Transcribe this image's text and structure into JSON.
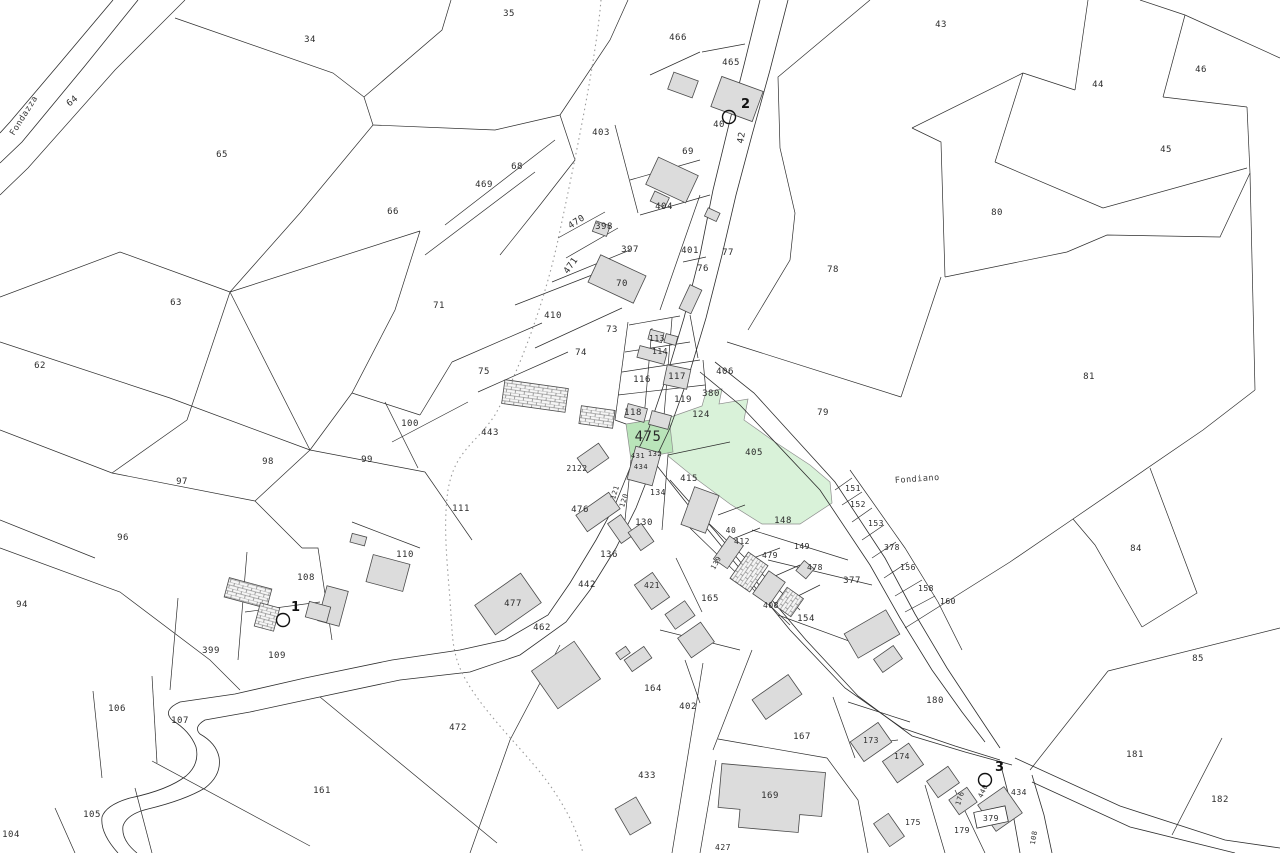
{
  "map": {
    "type": "cadastral-parcel-map",
    "background_color": "#ffffff",
    "line_color": "#2e2e2e",
    "building_fill": "#dcdcdc",
    "highlight_fill": "#d9f2d9",
    "highlight_strong_fill": "#b9e4b9",
    "street_names": [
      {
        "text": "Fondazza",
        "x": 14,
        "y": 136,
        "rotation": -58,
        "size": 8.5,
        "letter_spacing": 3
      },
      {
        "text": "Fondiano",
        "x": 895,
        "y": 483,
        "rotation": -4,
        "size": 8.5,
        "letter_spacing": 2
      }
    ],
    "parcel_labels": [
      {
        "t": "34",
        "x": 310,
        "y": 42
      },
      {
        "t": "35",
        "x": 509,
        "y": 16
      },
      {
        "t": "466",
        "x": 678,
        "y": 40
      },
      {
        "t": "465",
        "x": 731,
        "y": 65
      },
      {
        "t": "40",
        "x": 719,
        "y": 127
      },
      {
        "t": "42",
        "x": 744,
        "y": 138,
        "r": -80
      },
      {
        "t": "403",
        "x": 601,
        "y": 135
      },
      {
        "t": "69",
        "x": 688,
        "y": 154
      },
      {
        "t": "43",
        "x": 941,
        "y": 27
      },
      {
        "t": "46",
        "x": 1201,
        "y": 72
      },
      {
        "t": "44",
        "x": 1098,
        "y": 87
      },
      {
        "t": "45",
        "x": 1166,
        "y": 152
      },
      {
        "t": "64",
        "x": 74,
        "y": 103,
        "r": -40
      },
      {
        "t": "65",
        "x": 222,
        "y": 157
      },
      {
        "t": "68",
        "x": 517,
        "y": 169
      },
      {
        "t": "469",
        "x": 484,
        "y": 187
      },
      {
        "t": "404",
        "x": 664,
        "y": 209
      },
      {
        "t": "66",
        "x": 393,
        "y": 214
      },
      {
        "t": "80",
        "x": 997,
        "y": 215
      },
      {
        "t": "470",
        "x": 578,
        "y": 224,
        "r": -33
      },
      {
        "t": "398",
        "x": 604,
        "y": 229
      },
      {
        "t": "397",
        "x": 630,
        "y": 252
      },
      {
        "t": "471",
        "x": 573,
        "y": 267,
        "r": -55
      },
      {
        "t": "401",
        "x": 690,
        "y": 253
      },
      {
        "t": "77",
        "x": 728,
        "y": 255
      },
      {
        "t": "76",
        "x": 703,
        "y": 271
      },
      {
        "t": "70",
        "x": 622,
        "y": 286
      },
      {
        "t": "78",
        "x": 833,
        "y": 272
      },
      {
        "t": "63",
        "x": 176,
        "y": 305
      },
      {
        "t": "71",
        "x": 439,
        "y": 308
      },
      {
        "t": "410",
        "x": 553,
        "y": 318
      },
      {
        "t": "73",
        "x": 612,
        "y": 332
      },
      {
        "t": "74",
        "x": 581,
        "y": 355
      },
      {
        "t": "113",
        "x": 657,
        "y": 341,
        "s": 8
      },
      {
        "t": "114",
        "x": 660,
        "y": 354,
        "s": 8
      },
      {
        "t": "62",
        "x": 40,
        "y": 368
      },
      {
        "t": "75",
        "x": 484,
        "y": 374
      },
      {
        "t": "116",
        "x": 642,
        "y": 382
      },
      {
        "t": "117",
        "x": 677,
        "y": 379
      },
      {
        "t": "406",
        "x": 725,
        "y": 374
      },
      {
        "t": "380",
        "x": 711,
        "y": 396
      },
      {
        "t": "81",
        "x": 1089,
        "y": 379
      },
      {
        "t": "119",
        "x": 683,
        "y": 402
      },
      {
        "t": "79",
        "x": 823,
        "y": 415
      },
      {
        "t": "124",
        "x": 701,
        "y": 417
      },
      {
        "t": "118",
        "x": 633,
        "y": 415
      },
      {
        "t": "100",
        "x": 410,
        "y": 426
      },
      {
        "t": "443",
        "x": 490,
        "y": 435
      },
      {
        "t": "475",
        "x": 648,
        "y": 441,
        "s": 14
      },
      {
        "t": "98",
        "x": 268,
        "y": 464
      },
      {
        "t": "99",
        "x": 367,
        "y": 462
      },
      {
        "t": "2122",
        "x": 577,
        "y": 471,
        "s": 8
      },
      {
        "t": "431",
        "x": 638,
        "y": 458,
        "s": 7
      },
      {
        "t": "132",
        "x": 655,
        "y": 456,
        "s": 7
      },
      {
        "t": "434",
        "x": 641,
        "y": 469,
        "s": 7
      },
      {
        "t": "405",
        "x": 754,
        "y": 455
      },
      {
        "t": "415",
        "x": 689,
        "y": 481
      },
      {
        "t": "97",
        "x": 182,
        "y": 484
      },
      {
        "t": "151",
        "x": 853,
        "y": 491,
        "s": 8
      },
      {
        "t": "134",
        "x": 658,
        "y": 495,
        "s": 8
      },
      {
        "t": "121",
        "x": 617,
        "y": 493,
        "r": -72,
        "s": 7
      },
      {
        "t": "120",
        "x": 626,
        "y": 501,
        "r": -72,
        "s": 7
      },
      {
        "t": "152",
        "x": 858,
        "y": 507,
        "s": 8
      },
      {
        "t": "476",
        "x": 580,
        "y": 512
      },
      {
        "t": "111",
        "x": 461,
        "y": 511
      },
      {
        "t": "148",
        "x": 783,
        "y": 523
      },
      {
        "t": "130",
        "x": 644,
        "y": 525
      },
      {
        "t": "153",
        "x": 876,
        "y": 526,
        "s": 8
      },
      {
        "t": "40",
        "x": 731,
        "y": 533,
        "s": 8
      },
      {
        "t": "96",
        "x": 123,
        "y": 540
      },
      {
        "t": "412",
        "x": 742,
        "y": 544,
        "s": 8
      },
      {
        "t": "84",
        "x": 1136,
        "y": 551
      },
      {
        "t": "378",
        "x": 892,
        "y": 550,
        "s": 8
      },
      {
        "t": "149",
        "x": 802,
        "y": 549,
        "s": 8
      },
      {
        "t": "110",
        "x": 405,
        "y": 557
      },
      {
        "t": "136",
        "x": 609,
        "y": 557
      },
      {
        "t": "479",
        "x": 770,
        "y": 558,
        "s": 8
      },
      {
        "t": "139",
        "x": 718,
        "y": 564,
        "r": -60,
        "s": 7
      },
      {
        "t": "156",
        "x": 908,
        "y": 570,
        "s": 8
      },
      {
        "t": "478",
        "x": 815,
        "y": 570,
        "s": 8
      },
      {
        "t": "108",
        "x": 306,
        "y": 580
      },
      {
        "t": "377",
        "x": 852,
        "y": 583
      },
      {
        "t": "442",
        "x": 587,
        "y": 587
      },
      {
        "t": "421",
        "x": 652,
        "y": 588,
        "s": 8
      },
      {
        "t": "158",
        "x": 926,
        "y": 591,
        "s": 8
      },
      {
        "t": "165",
        "x": 710,
        "y": 601
      },
      {
        "t": "160",
        "x": 948,
        "y": 604,
        "s": 8
      },
      {
        "t": "94",
        "x": 22,
        "y": 607
      },
      {
        "t": "477",
        "x": 513,
        "y": 606
      },
      {
        "t": "408",
        "x": 771,
        "y": 608,
        "s": 8
      },
      {
        "t": "154",
        "x": 806,
        "y": 621
      },
      {
        "t": "462",
        "x": 542,
        "y": 630
      },
      {
        "t": "399",
        "x": 211,
        "y": 653
      },
      {
        "t": "109",
        "x": 277,
        "y": 658
      },
      {
        "t": "85",
        "x": 1198,
        "y": 661
      },
      {
        "t": "164",
        "x": 653,
        "y": 691
      },
      {
        "t": "180",
        "x": 935,
        "y": 703
      },
      {
        "t": "402",
        "x": 688,
        "y": 709
      },
      {
        "t": "106",
        "x": 117,
        "y": 711
      },
      {
        "t": "107",
        "x": 180,
        "y": 723
      },
      {
        "t": "472",
        "x": 458,
        "y": 730
      },
      {
        "t": "167",
        "x": 802,
        "y": 739
      },
      {
        "t": "173",
        "x": 871,
        "y": 743,
        "s": 8
      },
      {
        "t": "181",
        "x": 1135,
        "y": 757
      },
      {
        "t": "174",
        "x": 902,
        "y": 759,
        "s": 8
      },
      {
        "t": "433",
        "x": 647,
        "y": 778
      },
      {
        "t": "161",
        "x": 322,
        "y": 793
      },
      {
        "t": "176",
        "x": 962,
        "y": 799,
        "r": -72,
        "s": 7
      },
      {
        "t": "440",
        "x": 985,
        "y": 792,
        "r": -65,
        "s": 7
      },
      {
        "t": "434",
        "x": 1019,
        "y": 795,
        "s": 8
      },
      {
        "t": "169",
        "x": 770,
        "y": 798
      },
      {
        "t": "182",
        "x": 1220,
        "y": 802
      },
      {
        "t": "105",
        "x": 92,
        "y": 817
      },
      {
        "t": "175",
        "x": 913,
        "y": 825,
        "s": 8
      },
      {
        "t": "179",
        "x": 962,
        "y": 833,
        "s": 8
      },
      {
        "t": "104",
        "x": 11,
        "y": 837
      },
      {
        "t": "108",
        "x": 1036,
        "y": 838,
        "r": -80,
        "s": 7
      },
      {
        "t": "427",
        "x": 723,
        "y": 850,
        "s": 8
      }
    ],
    "boxed_label": {
      "t": "379",
      "x": 991,
      "y": 821,
      "s": 8
    },
    "survey_markers": [
      {
        "label": "1",
        "circle_x": 283,
        "circle_y": 620,
        "text_x": 291,
        "text_y": 611
      },
      {
        "label": "2",
        "circle_x": 729,
        "circle_y": 117,
        "text_x": 741,
        "text_y": 108
      },
      {
        "label": "3",
        "circle_x": 985,
        "circle_y": 780,
        "text_x": 995,
        "text_y": 771
      }
    ],
    "highlighted_parcels": [
      "405",
      "475"
    ]
  }
}
